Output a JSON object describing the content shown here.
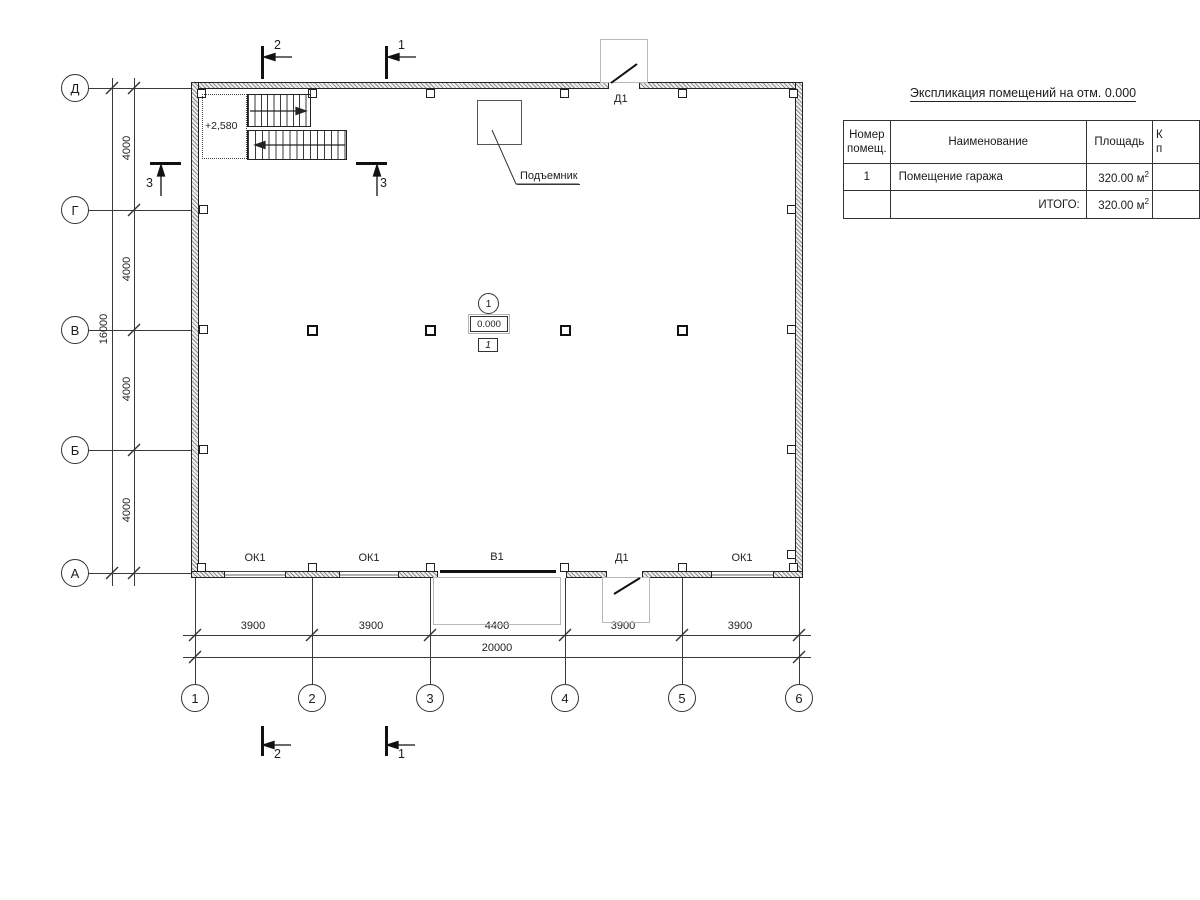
{
  "spec_table": {
    "title": "Экспликация помещений на отм. 0.000",
    "headers": {
      "col1_line1": "Номер",
      "col1_line2": "помещ.",
      "col2": "Наименование",
      "col3": "Площадь",
      "col4_line1": "К",
      "col4_line2": "п"
    },
    "rows": [
      {
        "num": "1",
        "name": "Помещение гаража",
        "area": "320.00 м",
        "area_sup": "2"
      }
    ],
    "total": {
      "label": "ИТОГО:",
      "area": "320.00 м",
      "area_sup": "2"
    }
  },
  "axes": {
    "left": [
      "Д",
      "Г",
      "В",
      "Б",
      "А"
    ],
    "bottom": [
      "1",
      "2",
      "3",
      "4",
      "5",
      "6"
    ]
  },
  "dimensions": {
    "bottom_segments": [
      "3900",
      "3900",
      "4400",
      "3900",
      "3900"
    ],
    "bottom_total": "20000",
    "left_segments": [
      "4000",
      "4000",
      "4000",
      "4000"
    ],
    "left_total": "16000"
  },
  "sections": {
    "top": [
      "2",
      "1"
    ],
    "bottom": [
      "2",
      "1"
    ],
    "side": [
      "3",
      "3"
    ]
  },
  "labels": {
    "stair_level": "+2,580",
    "lift": "Подъемник",
    "door": "Д1",
    "gate": "В1",
    "window": "ОК1"
  },
  "room_tag": {
    "number": "1",
    "level": "0.000",
    "type": "1"
  }
}
